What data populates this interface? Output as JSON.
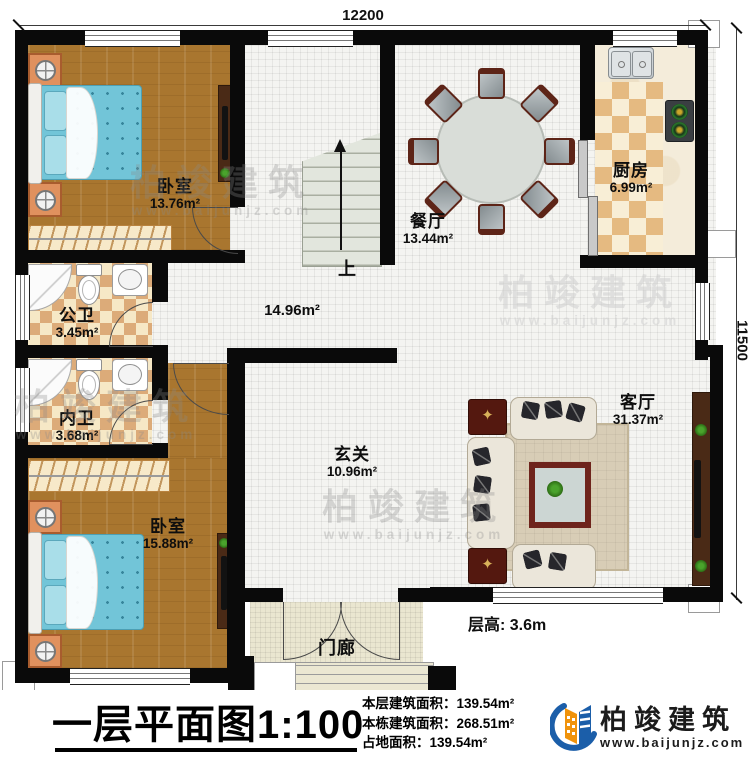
{
  "dimensions": {
    "top": "12200",
    "right": "11500"
  },
  "rooms": [
    {
      "name": "卧室",
      "area": "13.76m²"
    },
    {
      "name": "餐厅",
      "area": "13.44m²"
    },
    {
      "name": "厨房",
      "area": "6.99m²"
    },
    {
      "name": "公卫",
      "area": "3.45m²"
    },
    {
      "name": "内卫",
      "area": "3.68m²"
    },
    {
      "name": "卧室",
      "area": "15.88m²"
    },
    {
      "name": "",
      "area": "14.96m²"
    },
    {
      "name": "玄关",
      "area": "10.96m²"
    },
    {
      "name": "客厅",
      "area": "31.37m²"
    },
    {
      "name": "门廊",
      "area": ""
    }
  ],
  "stairs": {
    "direction": "上"
  },
  "annotations": {
    "floor_height": "层高: 3.6m"
  },
  "footer": {
    "title": "一层平面图",
    "scale": "1:100",
    "stats": [
      {
        "label": "本层建筑面积：",
        "value": "139.54m²"
      },
      {
        "label": "本栋建筑面积：",
        "value": "268.51m²"
      },
      {
        "label": "占地面积：",
        "value": "139.54m²"
      }
    ],
    "brand": {
      "name": "柏竣建筑",
      "website": "www.baijunjz.com"
    }
  },
  "watermark": {
    "name": "柏竣建筑",
    "website": "www.baijunjz.com"
  },
  "colors": {
    "wall": "#0a0a0a",
    "wood": "#a9762f",
    "bath_tile": "#dcab79",
    "accent_blue": "#1b5ea9",
    "accent_orange": "#f0930c"
  }
}
